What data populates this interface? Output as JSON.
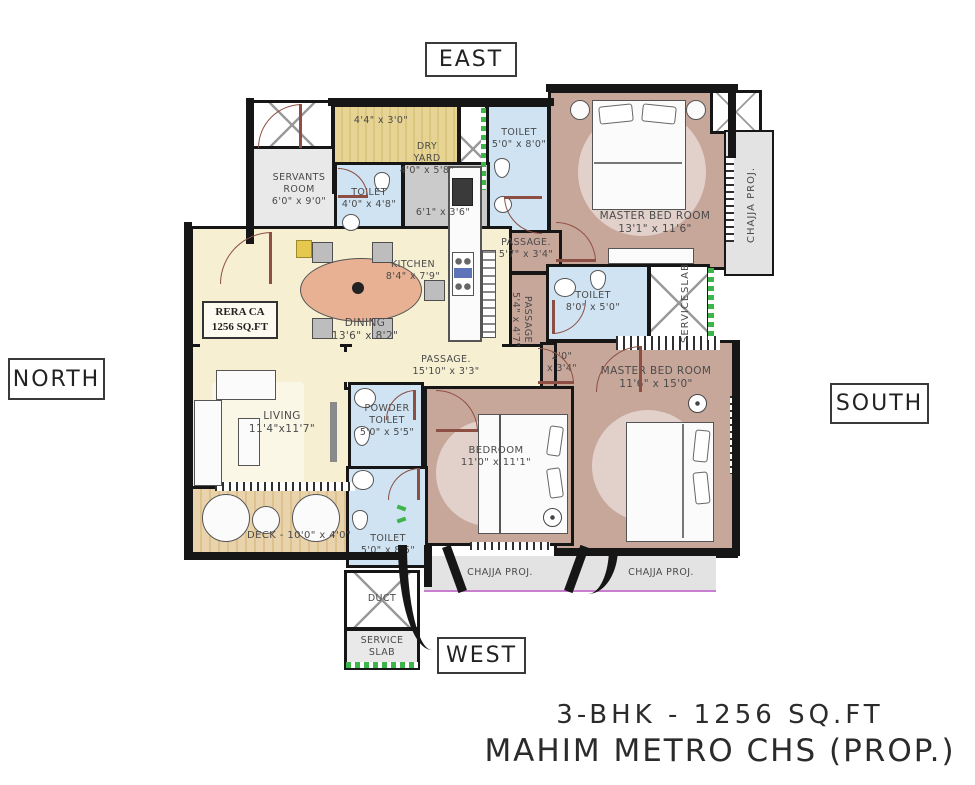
{
  "compass": {
    "east": "EAST",
    "west": "WEST",
    "north": "NORTH",
    "south": "SOUTH"
  },
  "title": {
    "line1": "3-BHK - 1256 SQ.FT",
    "line2": "MAHIM METRO CHS (PROP.)"
  },
  "rera": {
    "line1": "RERA CA",
    "line2": "1256 SQ.FT"
  },
  "rooms": {
    "servants": {
      "name": "SERVANTS ROOM",
      "dims": "6'0\" x 9'0\""
    },
    "yard": {
      "ledge_dims": "4'4\" x 3'0\"",
      "name": "DRY YARD",
      "dims": "4'0\" x 5'8\""
    },
    "toiletTop": {
      "name": "TOILET",
      "dims": "5'0\" x 8'0\""
    },
    "master1": {
      "name": "MASTER BED ROOM",
      "dims": "13'1\" x 11'6\""
    },
    "chajjaRight": {
      "label": "CHAJJA PROJ."
    },
    "toiletServant": {
      "name": "TOILET",
      "dims": "4'0\" x 4'8\""
    },
    "passageKitchen": {
      "dims": "6'1\" x 3'6\""
    },
    "kitchen": {
      "name": "KITCHEN",
      "dims": "8'4\" x 7'9\""
    },
    "passage1": {
      "name": "PASSAGE.",
      "dims": "5'7\" x 3'4\""
    },
    "passage2": {
      "name": "PASSAGE",
      "dims": "5'4\" x 4'7\""
    },
    "toiletMid": {
      "name": "TOILET",
      "dims": "8'0\" x 5'0\""
    },
    "serviceSlabRight": {
      "line1": "SERVICE",
      "line2": "SLAB"
    },
    "dining": {
      "name": "DINING",
      "dims": "13'6\" x 8'2\""
    },
    "passageMain": {
      "name": "PASSAGE.",
      "dims": "15'10\" x 3'3\""
    },
    "niche": {
      "line1": "2'0\"",
      "line2": "x 3'4\""
    },
    "master2": {
      "name": "MASTER BED ROOM",
      "dims": "11'6\" x 15'0\""
    },
    "living": {
      "name": "LIVING",
      "dims": "11'4\"x11'7\""
    },
    "powder": {
      "line1": "POWDER",
      "line2": "TOILET",
      "dims": "5'0\" x 5'5\""
    },
    "bedroom": {
      "name": "BEDROOM",
      "dims": "11'0\" x 11'1\""
    },
    "deck": {
      "label": "DECK - 10'0\" x 4'0\""
    },
    "toiletBottom": {
      "name": "TOILET",
      "dims": "5'0\" x 8'5\""
    },
    "duct": {
      "label": "DUCT"
    },
    "serviceSlabBottom": {
      "line1": "SERVICE",
      "line2": "SLAB"
    },
    "chajjaBottom1": {
      "label": "CHAJJA PROJ."
    },
    "chajjaBottom2": {
      "label": "CHAJJA PROJ."
    }
  },
  "colors": {
    "wall": "#161616",
    "bedroomFill": "#c8a79b",
    "livingFill": "#f6efd2",
    "toiletFill": "#cfe3f2",
    "kitchenFill": "#cbcbcb",
    "servantFill": "#e9e9e9",
    "deckFill": "#e9d3ac",
    "dryYardFill": "#e7d494",
    "chajjaFill": "#e3e3e3",
    "doorColor": "#8d4f43",
    "accentGreen": "#3db54a",
    "accentMagenta": "#c87fd0"
  }
}
